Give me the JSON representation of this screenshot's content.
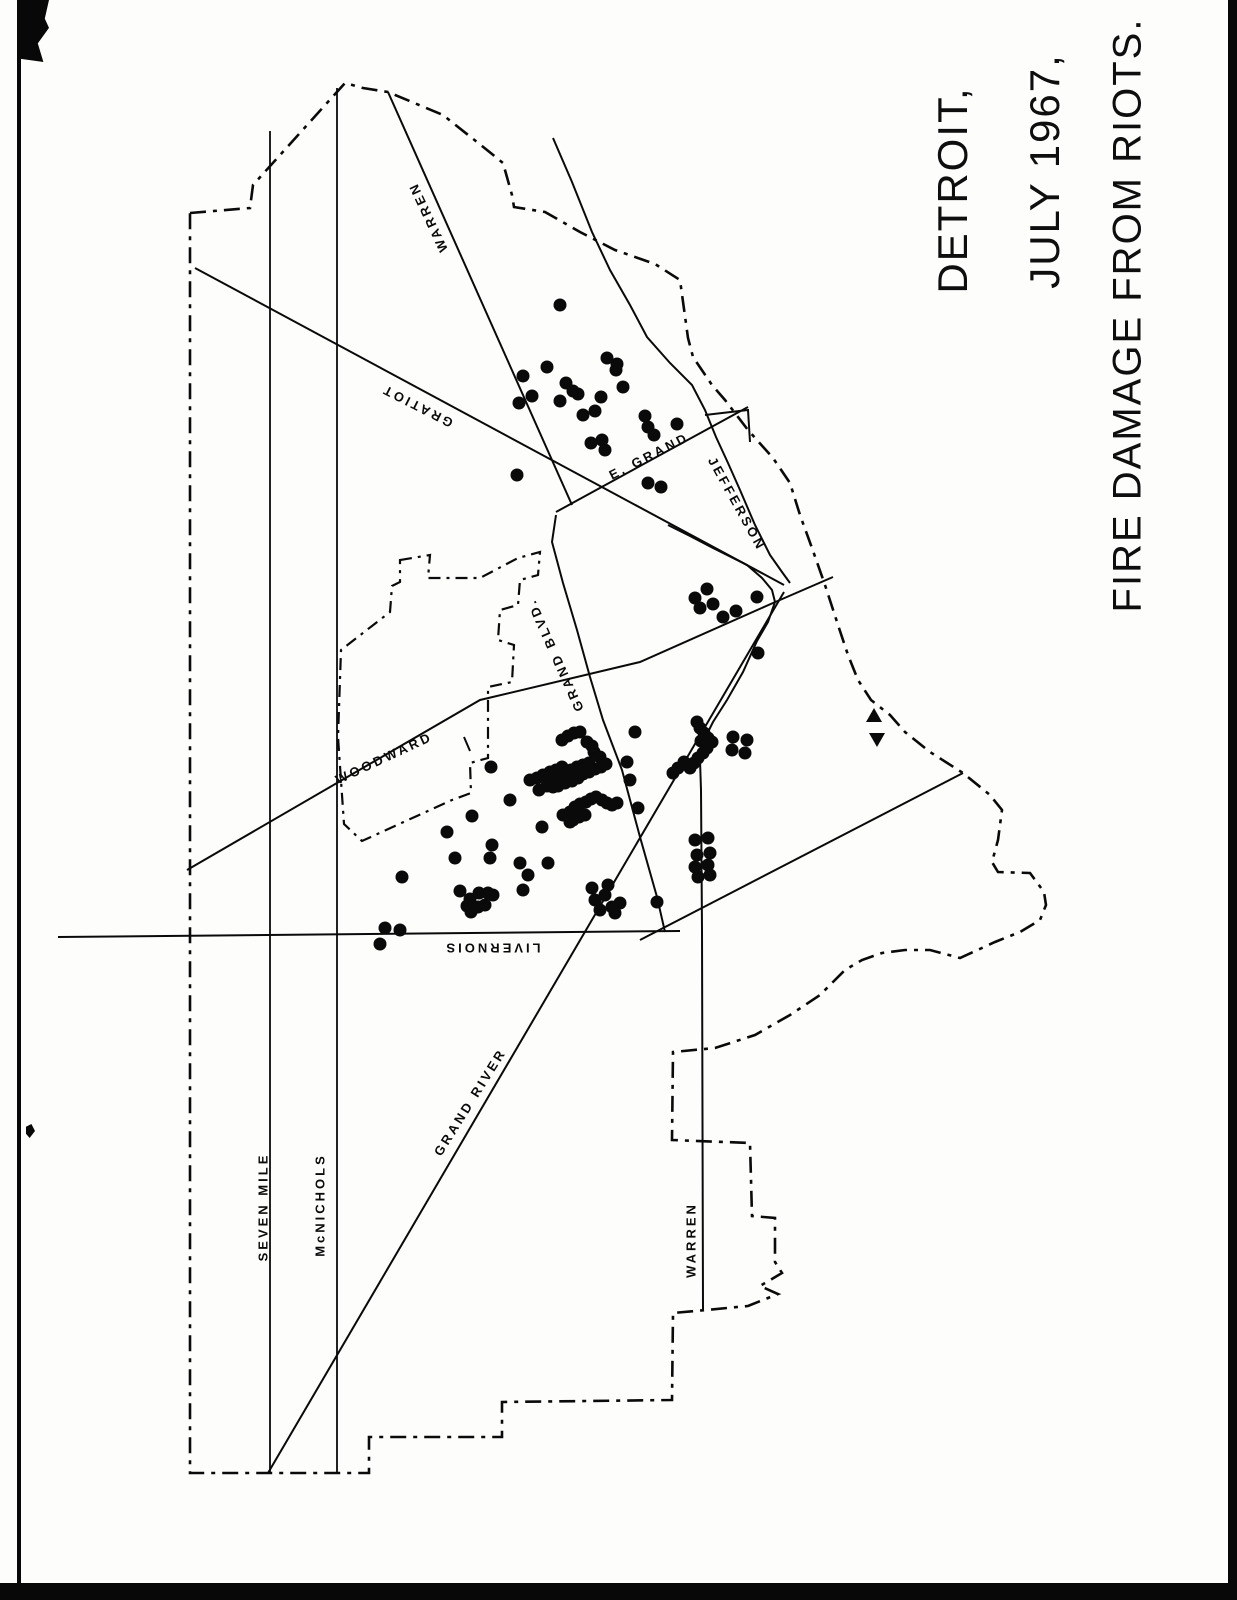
{
  "title": {
    "line1": "DETROIT,",
    "line2": "JULY 1967,",
    "line3": "FIRE DAMAGE FROM RIOTS."
  },
  "legend": {
    "fire_symbol": "black-dot",
    "marker_symbols": [
      "up-triangle",
      "down-triangle"
    ]
  },
  "colors": {
    "ink": "#0a0a0a",
    "paper": "#fdfdfc"
  },
  "street_labels": [
    {
      "name": "warren-north",
      "text": "WARREN",
      "x": 428,
      "y": 217,
      "angle": -115
    },
    {
      "name": "gratiot",
      "text": "GRATIOT",
      "x": 417,
      "y": 406,
      "angle": -153
    },
    {
      "name": "e-grand",
      "text": "E. GRAND",
      "x": 649,
      "y": 456,
      "angle": -27
    },
    {
      "name": "jefferson",
      "text": "JEFFERSON",
      "x": 737,
      "y": 504,
      "angle": 61
    },
    {
      "name": "woodward",
      "text": "WOODWARD",
      "x": 384,
      "y": 758,
      "angle": -25
    },
    {
      "name": "grand-blvd",
      "text": "GRAND BLVD.",
      "x": 555,
      "y": 655,
      "angle": -114
    },
    {
      "name": "livernois",
      "text": "LIVERNOIS",
      "x": 492,
      "y": 948,
      "angle": 180
    },
    {
      "name": "grand-river",
      "text": "GRAND RIVER",
      "x": 470,
      "y": 1102,
      "angle": -58
    },
    {
      "name": "seven-mile",
      "text": "SEVEN MILE",
      "x": 263,
      "y": 1207,
      "angle": -90
    },
    {
      "name": "mcnichols",
      "text": "McNICHOLS",
      "x": 320,
      "y": 1205,
      "angle": -90
    },
    {
      "name": "warren-south",
      "text": "WARREN",
      "x": 691,
      "y": 1240,
      "angle": -90
    }
  ],
  "fires": [
    [
      560,
      305
    ],
    [
      547,
      367
    ],
    [
      523,
      376
    ],
    [
      532,
      396
    ],
    [
      519,
      403
    ],
    [
      566,
      383
    ],
    [
      573,
      391
    ],
    [
      560,
      401
    ],
    [
      578,
      394
    ],
    [
      607,
      358
    ],
    [
      617,
      364
    ],
    [
      616,
      370
    ],
    [
      623,
      387
    ],
    [
      601,
      397
    ],
    [
      583,
      415
    ],
    [
      595,
      411
    ],
    [
      645,
      416
    ],
    [
      648,
      427
    ],
    [
      654,
      435
    ],
    [
      677,
      424
    ],
    [
      591,
      443
    ],
    [
      602,
      440
    ],
    [
      605,
      450
    ],
    [
      517,
      475
    ],
    [
      648,
      483
    ],
    [
      661,
      487
    ],
    [
      695,
      598
    ],
    [
      707,
      589
    ],
    [
      700,
      608
    ],
    [
      713,
      604
    ],
    [
      723,
      617
    ],
    [
      736,
      611
    ],
    [
      757,
      597
    ],
    [
      758,
      653
    ],
    [
      697,
      722
    ],
    [
      700,
      728
    ],
    [
      704,
      733
    ],
    [
      708,
      738
    ],
    [
      712,
      742
    ],
    [
      707,
      748
    ],
    [
      703,
      753
    ],
    [
      698,
      758
    ],
    [
      694,
      763
    ],
    [
      690,
      768
    ],
    [
      684,
      762
    ],
    [
      678,
      768
    ],
    [
      673,
      773
    ],
    [
      701,
      741
    ],
    [
      733,
      737
    ],
    [
      747,
      740
    ],
    [
      732,
      750
    ],
    [
      745,
      753
    ],
    [
      635,
      732
    ],
    [
      627,
      762
    ],
    [
      630,
      780
    ],
    [
      638,
      808
    ],
    [
      695,
      840
    ],
    [
      708,
      838
    ],
    [
      697,
      855
    ],
    [
      710,
      853
    ],
    [
      695,
      867
    ],
    [
      708,
      865
    ],
    [
      698,
      877
    ],
    [
      710,
      875
    ],
    [
      657,
      902
    ],
    [
      595,
      900
    ],
    [
      605,
      895
    ],
    [
      600,
      910
    ],
    [
      612,
      907
    ],
    [
      620,
      903
    ],
    [
      608,
      885
    ],
    [
      592,
      888
    ],
    [
      615,
      913
    ],
    [
      562,
      740
    ],
    [
      568,
      736
    ],
    [
      574,
      733
    ],
    [
      580,
      732
    ],
    [
      587,
      742
    ],
    [
      592,
      746
    ],
    [
      594,
      752
    ],
    [
      600,
      757
    ],
    [
      530,
      780
    ],
    [
      537,
      778
    ],
    [
      543,
      775
    ],
    [
      550,
      772
    ],
    [
      556,
      770
    ],
    [
      562,
      767
    ],
    [
      571,
      770
    ],
    [
      577,
      767
    ],
    [
      583,
      765
    ],
    [
      589,
      763
    ],
    [
      553,
      780
    ],
    [
      559,
      778
    ],
    [
      566,
      776
    ],
    [
      572,
      781
    ],
    [
      578,
      778
    ],
    [
      583,
      774
    ],
    [
      589,
      772
    ],
    [
      595,
      769
    ],
    [
      601,
      767
    ],
    [
      606,
      764
    ],
    [
      547,
      786
    ],
    [
      553,
      787
    ],
    [
      539,
      790
    ],
    [
      558,
      786
    ],
    [
      565,
      783
    ],
    [
      563,
      815
    ],
    [
      570,
      812
    ],
    [
      575,
      807
    ],
    [
      580,
      804
    ],
    [
      586,
      802
    ],
    [
      591,
      799
    ],
    [
      596,
      797
    ],
    [
      602,
      800
    ],
    [
      607,
      803
    ],
    [
      612,
      805
    ],
    [
      617,
      803
    ],
    [
      573,
      820
    ],
    [
      579,
      817
    ],
    [
      585,
      815
    ],
    [
      570,
      822
    ],
    [
      577,
      810
    ],
    [
      491,
      767
    ],
    [
      510,
      800
    ],
    [
      472,
      816
    ],
    [
      447,
      832
    ],
    [
      455,
      858
    ],
    [
      402,
      877
    ],
    [
      492,
      845
    ],
    [
      490,
      858
    ],
    [
      520,
      863
    ],
    [
      528,
      875
    ],
    [
      542,
      827
    ],
    [
      548,
      863
    ],
    [
      460,
      891
    ],
    [
      470,
      899
    ],
    [
      479,
      893
    ],
    [
      488,
      893
    ],
    [
      467,
      906
    ],
    [
      485,
      905
    ],
    [
      493,
      895
    ],
    [
      471,
      912
    ],
    [
      478,
      907
    ],
    [
      523,
      890
    ],
    [
      385,
      928
    ],
    [
      400,
      930
    ],
    [
      380,
      944
    ]
  ],
  "triangles": [
    {
      "x": 874,
      "y": 716,
      "dir": "up"
    },
    {
      "x": 877,
      "y": 739,
      "dir": "down"
    }
  ]
}
